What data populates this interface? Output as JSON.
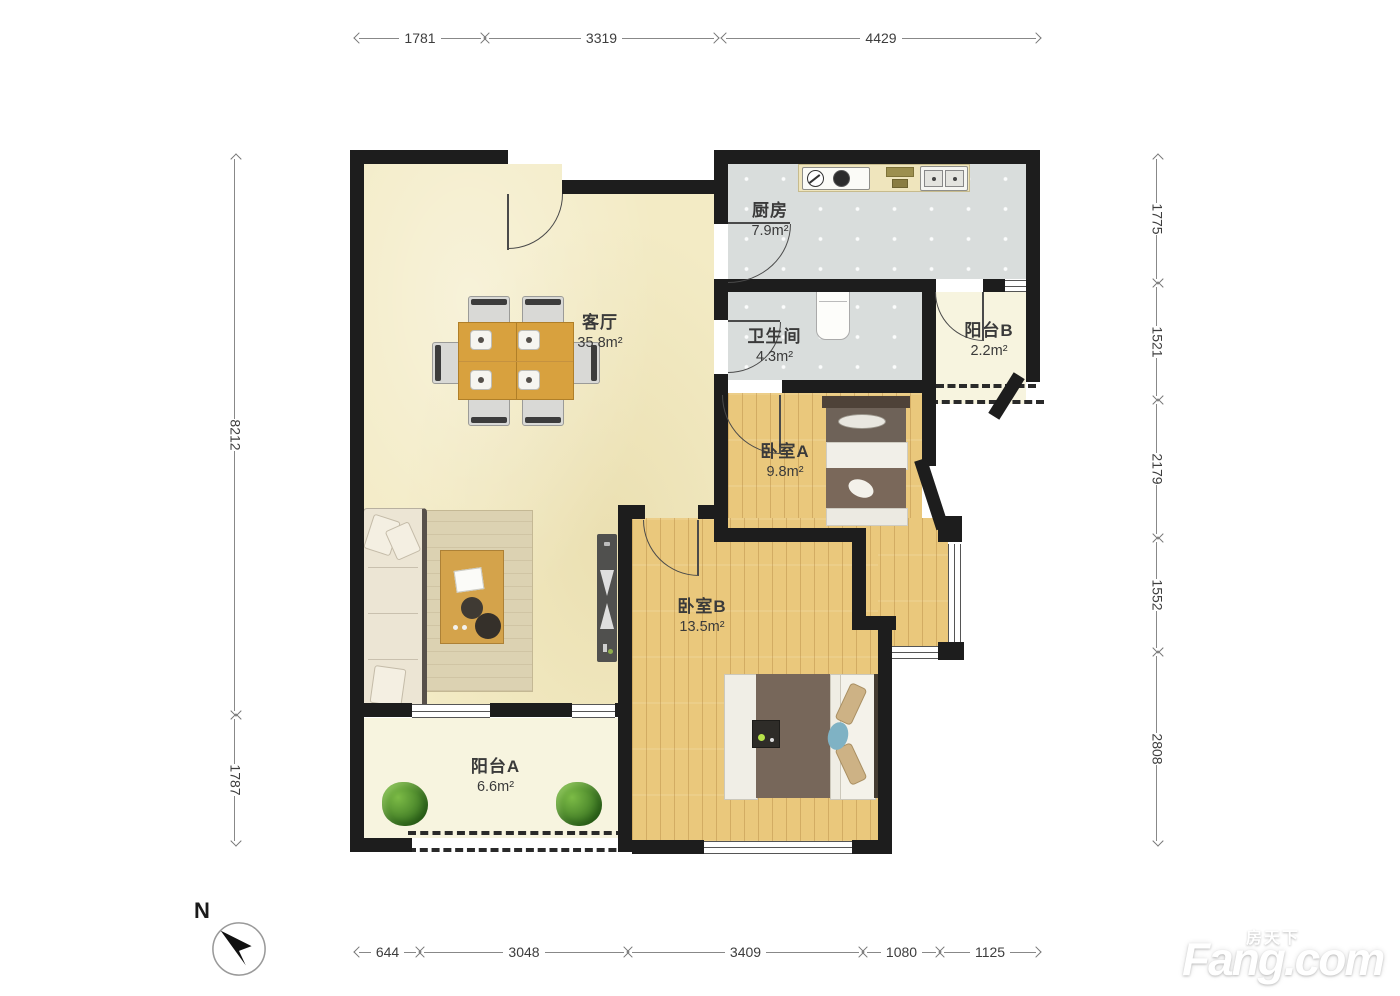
{
  "compass": {
    "label": "N"
  },
  "watermark": {
    "cn": "房天下",
    "en": "Fang.com"
  },
  "rooms": {
    "living": {
      "name": "客厅",
      "area": "35.8m²"
    },
    "kitchen": {
      "name": "厨房",
      "area": "7.9m²"
    },
    "bathroom": {
      "name": "卫生间",
      "area": "4.3m²"
    },
    "balconyB": {
      "name": "阳台B",
      "area": "2.2m²"
    },
    "bedroomA": {
      "name": "卧室A",
      "area": "9.8m²"
    },
    "bedroomB": {
      "name": "卧室B",
      "area": "13.5m²"
    },
    "balconyA": {
      "name": "阳台A",
      "area": "6.6m²"
    }
  },
  "dimensions": {
    "top": [
      "1781",
      "3319",
      "4429"
    ],
    "left": [
      "8212",
      "1787"
    ],
    "right": [
      "1775",
      "1521",
      "2179",
      "1552",
      "2808"
    ],
    "bottom": [
      "644",
      "3048",
      "3409",
      "1080",
      "1125"
    ]
  },
  "colors": {
    "wall": "#1d1d1d",
    "living_floor": "#f3ebc5",
    "tile_floor": "#d9dddc",
    "wood_floor": "#eac87c",
    "balcony_floor": "#f7f4df"
  }
}
